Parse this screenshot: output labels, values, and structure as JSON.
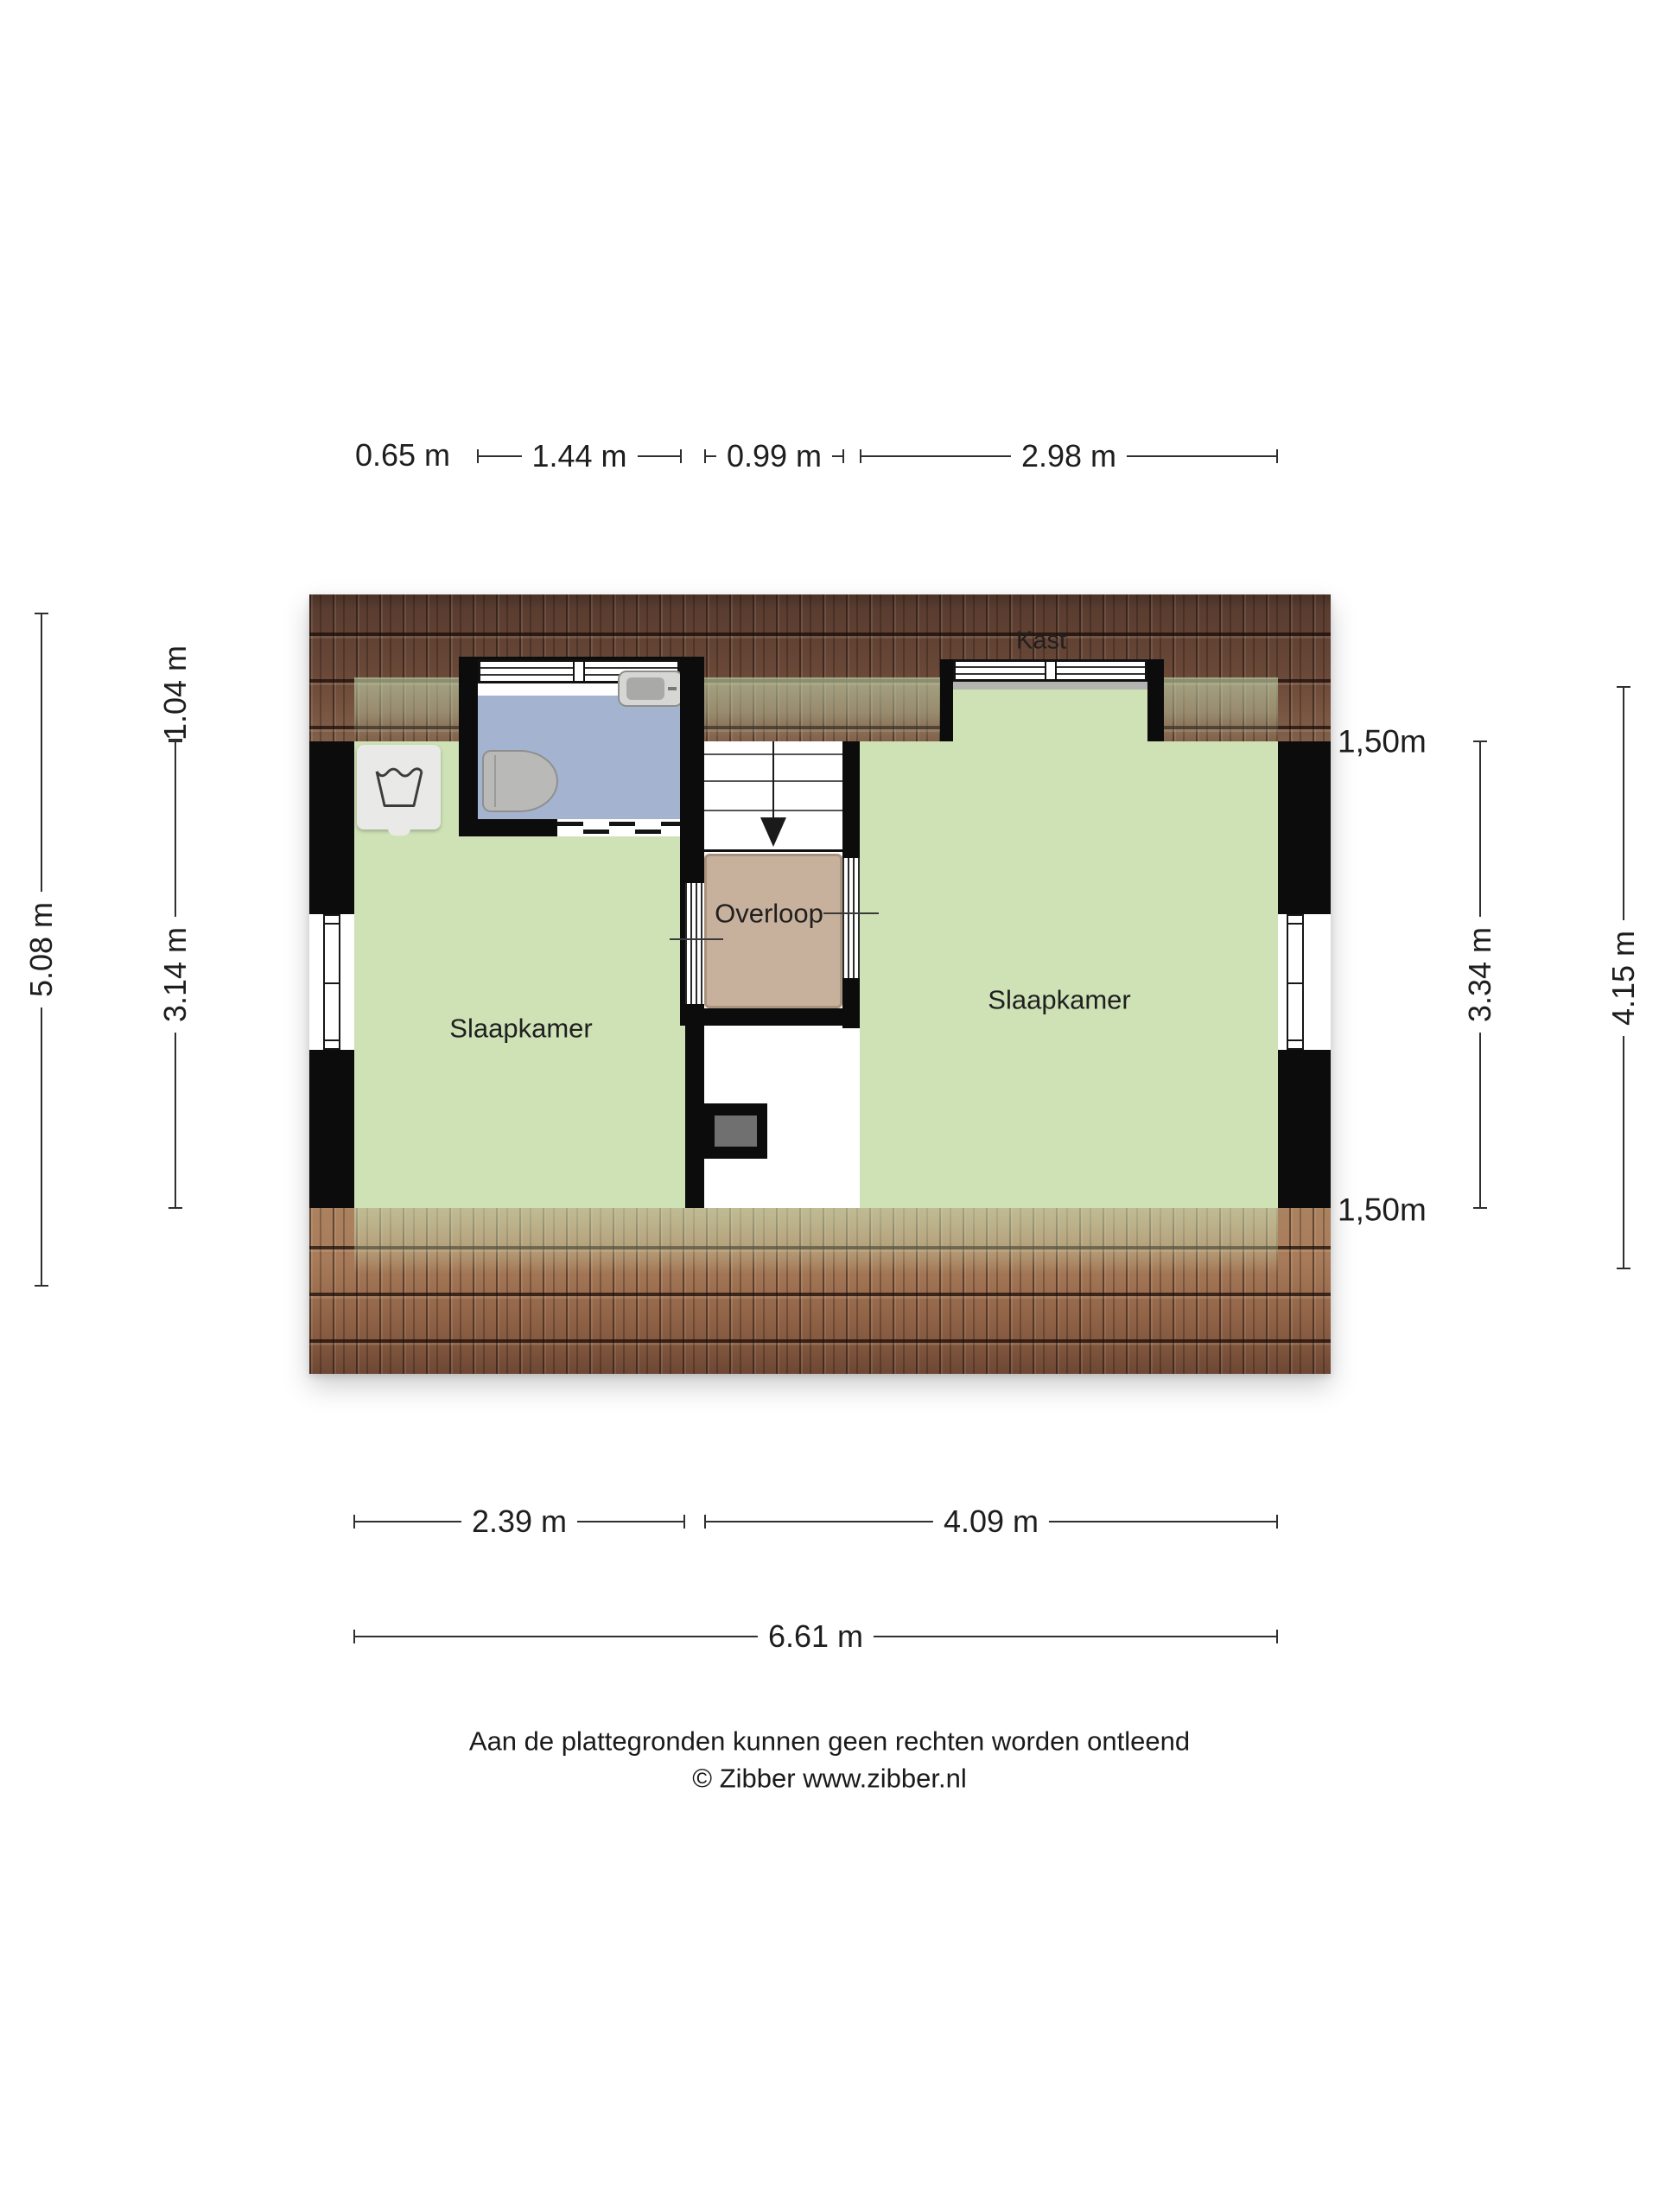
{
  "floorplan": {
    "rooms": {
      "bedroom_left": "Slaapkamer",
      "bedroom_right": "Slaapkamer",
      "landing": "Overloop",
      "closet": "Kast"
    }
  },
  "dims": {
    "top": [
      "0.65 m",
      "1.44 m",
      "0.99 m",
      "2.98 m"
    ],
    "bottom": [
      "2.39 m",
      "4.09 m",
      "6.61 m"
    ],
    "left": [
      "5.08 m",
      "1.04 m",
      "3.14 m"
    ],
    "right": [
      "3.34 m",
      "4.15 m"
    ],
    "height_markers": [
      "1,50m",
      "1,50m"
    ]
  },
  "footer": {
    "disclaimer": "Aan de plattegronden kunnen geen rechten worden ontleend",
    "credit": "© Zibber www.zibber.nl"
  },
  "colors": {
    "floor_green": "#cee2b6",
    "bathroom_blue": "#a4b4d0",
    "landing_tan": "#c8b19c",
    "roof_dark": "#5a3d30",
    "roof_light": "#a87c5a",
    "wall_black": "#0c0c0c",
    "fixture_gray": "#b9b9b7",
    "washer_gray": "#e9e9e7"
  }
}
